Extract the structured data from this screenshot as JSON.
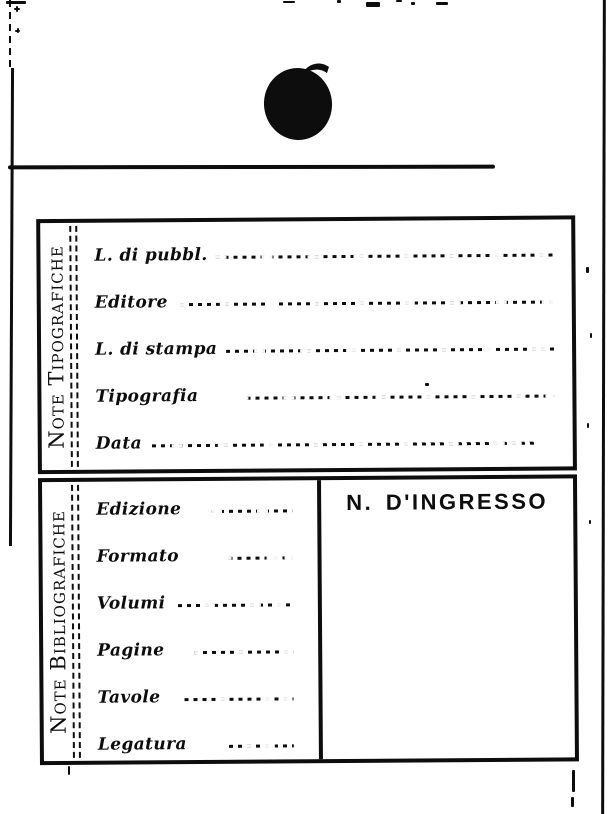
{
  "colors": {
    "ink": "#0d0d0d",
    "paper": "#ffffff"
  },
  "sections": {
    "tipografiche": {
      "side_label": "Note Tipografiche",
      "fields": [
        {
          "label": "L. di pubbl.",
          "value": ""
        },
        {
          "label": "Editore",
          "value": ""
        },
        {
          "label": "L. di stampa",
          "value": ""
        },
        {
          "label": "Tipografia",
          "value": ""
        },
        {
          "label": "Data",
          "value": ""
        }
      ]
    },
    "bibliografiche": {
      "side_label": "Note Bibliografiche",
      "fields": [
        {
          "label": "Edizione",
          "value": ""
        },
        {
          "label": "Formato",
          "value": ""
        },
        {
          "label": "Volumi",
          "value": ""
        },
        {
          "label": "Pagine",
          "value": ""
        },
        {
          "label": "Tavole",
          "value": ""
        },
        {
          "label": "Legatura",
          "value": ""
        }
      ],
      "ingresso_heading": "N. D'INGRESSO"
    }
  }
}
